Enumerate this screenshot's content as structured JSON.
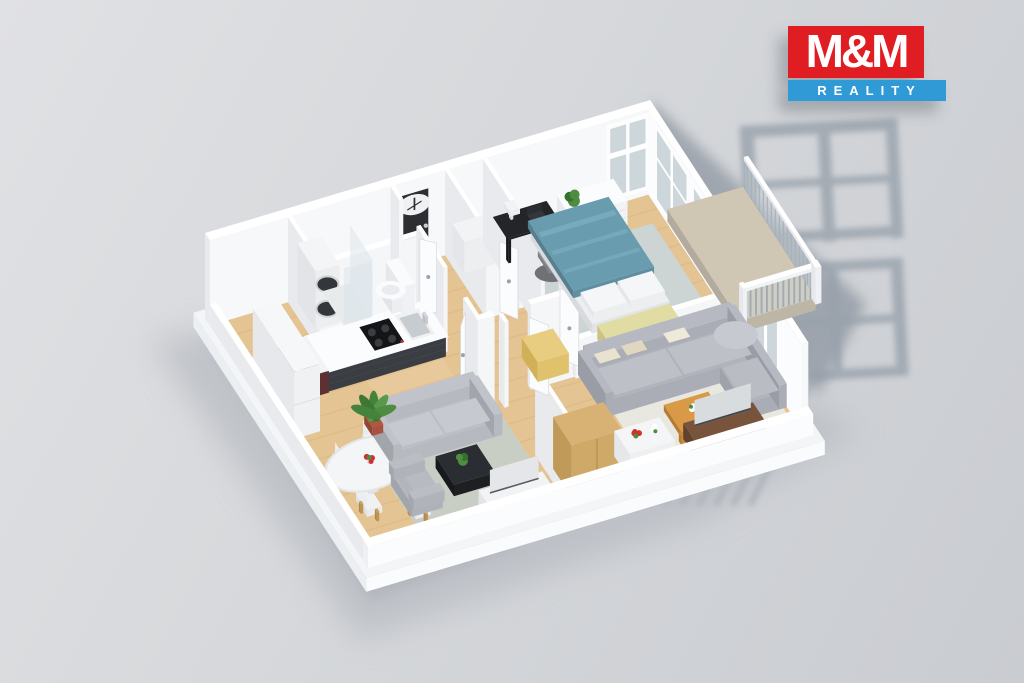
{
  "brand": {
    "name": "M&M Reality",
    "logo_text_top": "M&M",
    "logo_text_bottom": "REALITY",
    "logo_red": "#e11d24",
    "logo_blue": "#2f9ad6"
  },
  "scene": {
    "type": "3d-floor-plan-render",
    "background_top": "#e0e1e4",
    "background_bottom": "#c9ccd1",
    "palette": {
      "wallTop": "#ffffff",
      "wallS": "#f5f6f8",
      "wallW": "#e8eaee",
      "wood": "#e5c493",
      "woodStreak": "rgba(140,95,40,0.07)",
      "tile": "#d6dad6",
      "rugGreen": "#c9cec5",
      "rugWhite": "#e9e8e0",
      "rugBlue": "#ccd4d4",
      "counterDark": "#3a3d42",
      "counterDarker": "#2f3236",
      "maroon": "#5d3034",
      "maroonDark": "#502a2e",
      "black": "#1d1f22",
      "sofaGray": "#aaadb5",
      "sofaGrayLight": "#b6b9c1",
      "sofaLeft": "#b6b9bf",
      "cushion": "#e8e1cd",
      "bedBlue": "#6a9cb0",
      "bedBlueDark": "#618fa2",
      "bedBlueSide": "#577f90",
      "bedBlueHi": "#7cb0c2",
      "bench": "#e1dca4",
      "benchS": "#d7d194",
      "benchW": "#cac383",
      "tableWood": "#d89a46",
      "tableWoodS": "#c9883a",
      "tableWoodW": "#b87a33",
      "brown": "#6e4c36",
      "brownTop": "#79543c",
      "brownW": "#61422e",
      "tan": "#cfa968",
      "tanTop": "#d8b274",
      "tanW": "#c09a58",
      "mustard": "#e0c26d",
      "mustardTop": "#e8cd80",
      "mustardW": "#d1b158",
      "glass": "#ccd6db",
      "white": "#fafbfd",
      "whiteS": "#f0f1f4",
      "whiteW": "#e6e8ec",
      "chairGray": "#8f939a",
      "shadowWall": "#8d95a0",
      "shadowFrame": "#98a1ab",
      "shadowStripe": "#9aa3ad",
      "shadowGround": "#b0b4bb",
      "plantGreen": "#4e8c42",
      "plantDark": "#35702f",
      "terracotta": "#a9503e",
      "terracottaW": "#94452f",
      "red": "#d42f2f"
    },
    "rooms": [
      {
        "name": "kitchen-dining",
        "furniture": [
          "kitchen-counter",
          "induction-cooktop",
          "kitchen-sink",
          "kitchen-island",
          "tall-cabinet",
          "round-dining-table",
          "dining-chairs",
          "flower-vase"
        ]
      },
      {
        "name": "bathroom",
        "furniture": [
          "stacked-washer-dryer",
          "shower",
          "toilet"
        ]
      },
      {
        "name": "entry-hall",
        "furniture": [
          "entry-door"
        ]
      },
      {
        "name": "hallway",
        "furniture": [
          "storage-bench",
          "doors"
        ]
      },
      {
        "name": "living-room-left",
        "furniture": [
          "sofa",
          "armchair",
          "coffee-table",
          "tv-stand",
          "tv",
          "potted-palm"
        ]
      },
      {
        "name": "bedroom",
        "furniture": [
          "double-bed",
          "desk",
          "desk-lamp",
          "laptop",
          "office-chair",
          "dresser",
          "plant",
          "bedroom-bench"
        ]
      },
      {
        "name": "living-room-right",
        "furniture": [
          "corner-sofa",
          "coffee-table",
          "tv-sideboard",
          "tv",
          "wardrobe",
          "console-table",
          "flowers"
        ]
      },
      {
        "name": "balcony",
        "furniture": [
          "railing"
        ]
      }
    ]
  }
}
